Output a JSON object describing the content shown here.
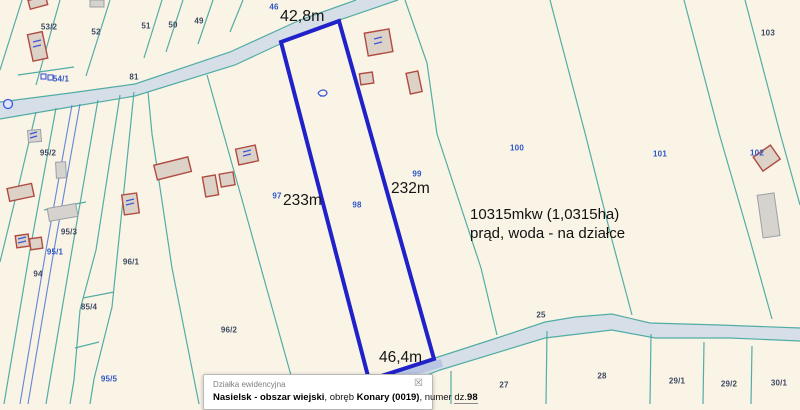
{
  "map": {
    "background": "#faf4e6",
    "boundary_teal": "#4aa9a1",
    "boundary_blue": "#5b7fd4",
    "highlight_outline": "#2121c9",
    "road_fill": "#d6dfe8",
    "measurements": {
      "top": "42,8m",
      "left": "233m",
      "right": "232m",
      "bottom": "46,4m"
    },
    "annotation": {
      "line1": "10315mkw (1,0315ha)",
      "line2": "prąd, woda - na działce"
    },
    "parcel_labels": [
      {
        "t": "53/2",
        "x": 49,
        "y": 27,
        "c": "d"
      },
      {
        "t": "52",
        "x": 96,
        "y": 32,
        "c": "d"
      },
      {
        "t": "51",
        "x": 146,
        "y": 26,
        "c": "d"
      },
      {
        "t": "50",
        "x": 173,
        "y": 25,
        "c": "d"
      },
      {
        "t": "49",
        "x": 199,
        "y": 21,
        "c": "d"
      },
      {
        "t": "46",
        "x": 274,
        "y": 7,
        "c": "b"
      },
      {
        "t": "103",
        "x": 768,
        "y": 33,
        "c": "d"
      },
      {
        "t": "81",
        "x": 134,
        "y": 77,
        "c": "d"
      },
      {
        "t": "54/1",
        "x": 61,
        "y": 79,
        "c": "b"
      },
      {
        "t": "95/2",
        "x": 48,
        "y": 153,
        "c": "d"
      },
      {
        "t": "100",
        "x": 517,
        "y": 148,
        "c": "b"
      },
      {
        "t": "102",
        "x": 757,
        "y": 153,
        "c": "b"
      },
      {
        "t": "101",
        "x": 660,
        "y": 154,
        "c": "b"
      },
      {
        "t": "99",
        "x": 417,
        "y": 174,
        "c": "b"
      },
      {
        "t": "97",
        "x": 277,
        "y": 196,
        "c": "b"
      },
      {
        "t": "98",
        "x": 357,
        "y": 205,
        "c": "b"
      },
      {
        "t": "95/3",
        "x": 69,
        "y": 232,
        "c": "d"
      },
      {
        "t": "95/1",
        "x": 55,
        "y": 252,
        "c": "b"
      },
      {
        "t": "96/1",
        "x": 131,
        "y": 262,
        "c": "d"
      },
      {
        "t": "94",
        "x": 38,
        "y": 274,
        "c": "d"
      },
      {
        "t": "85/4",
        "x": 89,
        "y": 307,
        "c": "d"
      },
      {
        "t": "96/2",
        "x": 229,
        "y": 330,
        "c": "d"
      },
      {
        "t": "95/5",
        "x": 109,
        "y": 379,
        "c": "b"
      },
      {
        "t": "25",
        "x": 541,
        "y": 315,
        "c": "d"
      },
      {
        "t": "27",
        "x": 504,
        "y": 385,
        "c": "d"
      },
      {
        "t": "28",
        "x": 602,
        "y": 376,
        "c": "d"
      },
      {
        "t": "29/1",
        "x": 677,
        "y": 381,
        "c": "d"
      },
      {
        "t": "29/2",
        "x": 729,
        "y": 384,
        "c": "d"
      },
      {
        "t": "30/1",
        "x": 779,
        "y": 383,
        "c": "d"
      }
    ]
  },
  "info_box": {
    "title": "Działka ewidencyjna",
    "close_glyph": "☒",
    "description_segments": [
      {
        "text": "Nasielsk - obszar wiejski",
        "bold": true,
        "underline": false
      },
      {
        "text": ", obręb ",
        "bold": false,
        "underline": false
      },
      {
        "text": "Konary (0019)",
        "bold": true,
        "underline": false
      },
      {
        "text": ", numer ",
        "bold": false,
        "underline": false
      },
      {
        "text": "dz.",
        "bold": false,
        "underline": true
      },
      {
        "text": "98",
        "bold": true,
        "underline": true
      }
    ]
  }
}
